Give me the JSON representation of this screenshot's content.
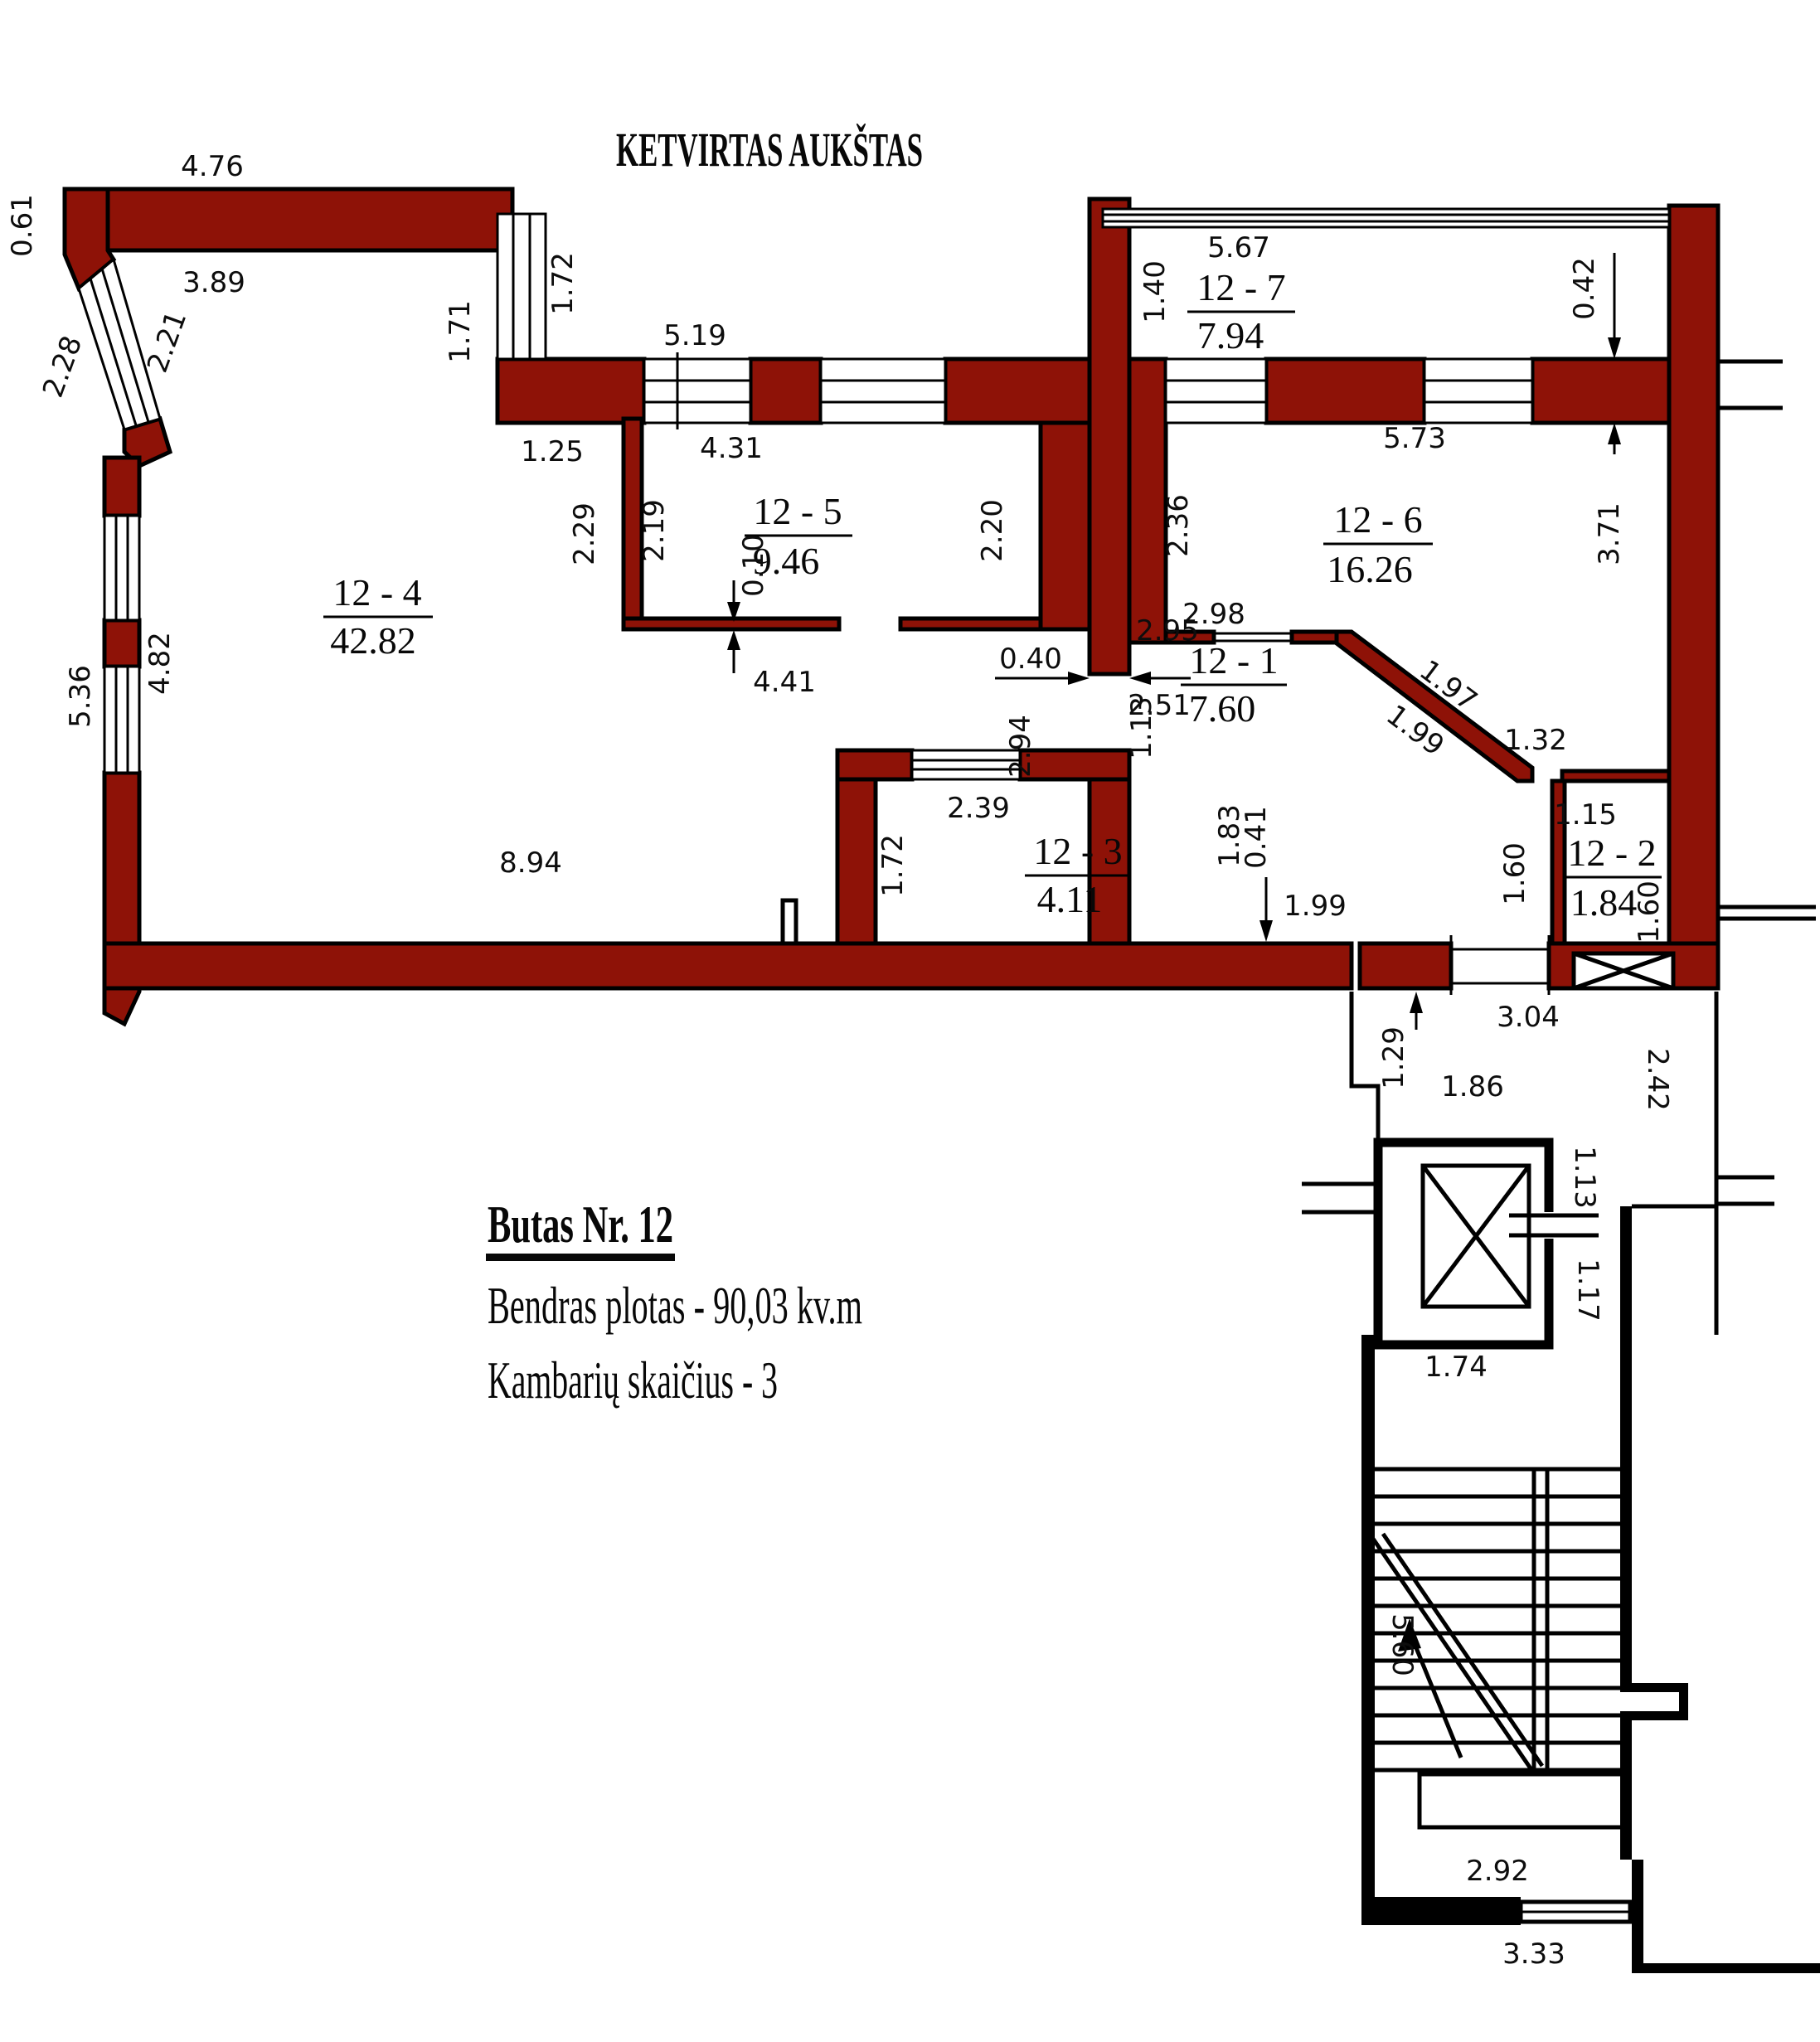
{
  "title": "KETVIRTAS AUKŠTAS",
  "info": {
    "line1": "Butas Nr. 12",
    "line2": "Bendras plotas - 90,03 kv.m",
    "line3": "Kambarių skaičius - 3"
  },
  "colors": {
    "wall": "#8e1207",
    "line": "#000000",
    "background": "#ffffff"
  },
  "rooms": {
    "r1": {
      "id": "12 - 1",
      "area": "7.60"
    },
    "r2": {
      "id": "12 - 2",
      "area": "1.84"
    },
    "r3": {
      "id": "12 - 3",
      "area": "4.11"
    },
    "r4": {
      "id": "12 - 4",
      "area": "42.82"
    },
    "r5": {
      "id": "12 - 5",
      "area": "9.46"
    },
    "r6": {
      "id": "12 - 6",
      "area": "16.26"
    },
    "r7": {
      "id": "12 - 7",
      "area": "7.94"
    }
  },
  "dims": {
    "top_width": "4.76",
    "corner_left": "0.61",
    "r4_top": "3.89",
    "bay_outer": "2.28",
    "bay_inner": "2.21",
    "win_left": "1.71",
    "win_right": "1.72",
    "wall_seg": "1.25",
    "band_top": "5.19",
    "r5_width": "4.31",
    "r5_left_h": "2.19",
    "niche_h": "2.29",
    "r5_right_h": "2.20",
    "thin_wall": "0.10",
    "r5_bottom": "4.41",
    "door_wall": "0.40",
    "door_r1": "1.13",
    "hall_h": "2.94",
    "r6_left_h": "2.36",
    "r7_left_h": "1.40",
    "r7_width": "5.67",
    "band_thk": "0.42",
    "r6_width": "5.73",
    "r6_right_h": "3.71",
    "r6_bottom": "2.98",
    "hall_top": "2.95",
    "hall_mid": "2.51",
    "diag_upper": "1.97",
    "diag_lower": "1.99",
    "r6_corner": "1.32",
    "r2_top": "1.15",
    "hall_right_h": "1.60",
    "r2_right_h": "1.60",
    "r3_top": "2.39",
    "r3_left_h": "1.72",
    "lobby_h": "1.83",
    "lobby_w": "0.41",
    "entry_w": "1.99",
    "left_win_upper": "4.82",
    "left_win_outer": "5.36",
    "r4_bottom": "8.94",
    "corr_top": "3.04",
    "corr_step": "1.29",
    "corr_w": "1.86",
    "corr_right": "2.42",
    "elev_top": "1.13",
    "elev_side": "1.17",
    "elev_bottom": "1.74",
    "stair_len": "5.60",
    "stair_w": "2.92",
    "stair_bottom": "3.33"
  }
}
